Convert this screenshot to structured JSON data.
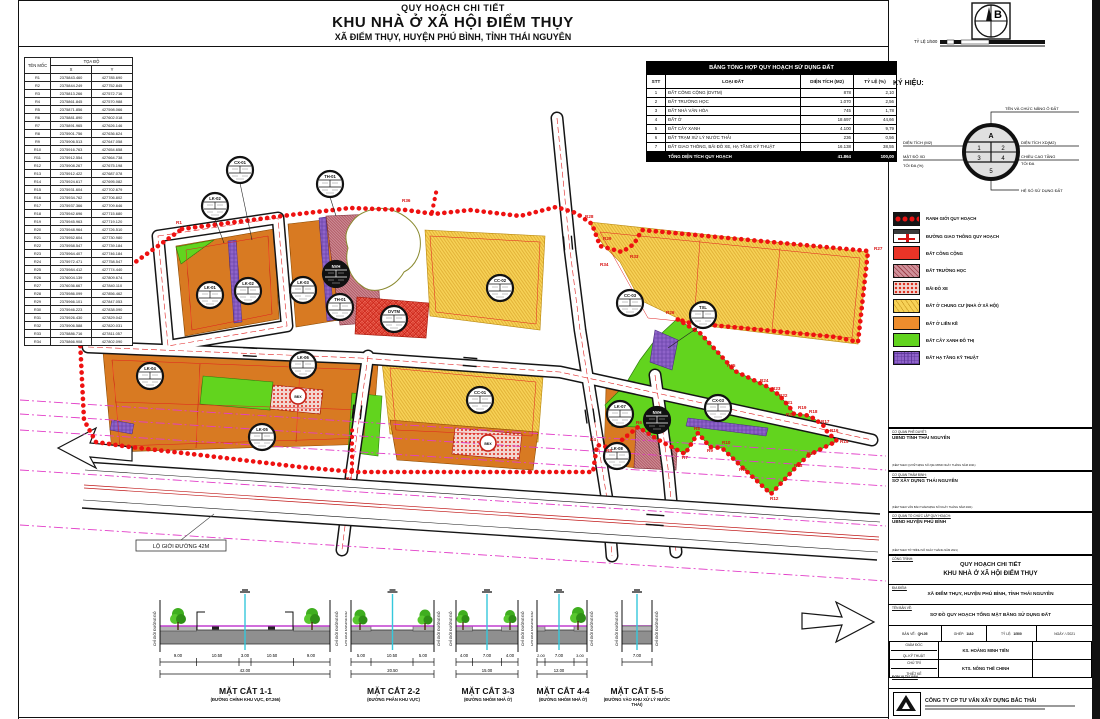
{
  "header": {
    "line1": "QUY HOẠCH CHI TIẾT",
    "line2": "KHU NHÀ Ở XÃ HỘI ĐIỂM THỤY",
    "line3": "XÃ ĐIỂM THỤY, HUYỆN PHÚ BÌNH, TỈNH THÁI NGUYÊN"
  },
  "north_label": "B",
  "scale_label": "TỶ LỆ 1/500",
  "coords": {
    "col_moc": "TÊN MỐC",
    "col_toado": "TỌA ĐỘ",
    "col_x": "X",
    "col_y": "Y",
    "rows": [
      {
        "id": "R1",
        "x": "2375843.460",
        "y": "427785.690"
      },
      {
        "id": "R2",
        "x": "2375844.249",
        "y": "427752.845"
      },
      {
        "id": "R3",
        "x": "2375813.266",
        "y": "427572.716"
      },
      {
        "id": "R4",
        "x": "2375861.845",
        "y": "427570.988"
      },
      {
        "id": "R5",
        "x": "2375871.856",
        "y": "427598.066"
      },
      {
        "id": "R6",
        "x": "2375881.890",
        "y": "427602.018"
      },
      {
        "id": "R7",
        "x": "2375891.965",
        "y": "427626.146"
      },
      {
        "id": "R8",
        "x": "2375901.756",
        "y": "427636.624"
      },
      {
        "id": "R9",
        "x": "2375906.513",
        "y": "427647.058"
      },
      {
        "id": "R10",
        "x": "2375916.763",
        "y": "427654.658"
      },
      {
        "id": "R11",
        "x": "2375912.554",
        "y": "427664.738"
      },
      {
        "id": "R12",
        "x": "2375908.267",
        "y": "427675.198"
      },
      {
        "id": "R13",
        "x": "2375912.422",
        "y": "427687.078"
      },
      {
        "id": "R14",
        "x": "2375924.617",
        "y": "427695.082"
      },
      {
        "id": "R15",
        "x": "2375931.604",
        "y": "427702.679"
      },
      {
        "id": "R16",
        "x": "2375934.762",
        "y": "427706.802"
      },
      {
        "id": "R17",
        "x": "2375937.366",
        "y": "427709.646"
      },
      {
        "id": "R18",
        "x": "2375942.696",
        "y": "427715.680"
      },
      {
        "id": "R19",
        "x": "2375945.963",
        "y": "427719.120"
      },
      {
        "id": "R20",
        "x": "2375948.964",
        "y": "427726.510"
      },
      {
        "id": "R21",
        "x": "2375952.604",
        "y": "427730.980"
      },
      {
        "id": "R22",
        "x": "2375958.547",
        "y": "427739.184"
      },
      {
        "id": "R23",
        "x": "2375964.407",
        "y": "427746.184"
      },
      {
        "id": "R24",
        "x": "2375972.471",
        "y": "427758.547"
      },
      {
        "id": "R25",
        "x": "2375984.412",
        "y": "427774.440"
      },
      {
        "id": "R26",
        "x": "2376004.139",
        "y": "427809.674"
      },
      {
        "id": "R27",
        "x": "2376036.667",
        "y": "427840.110"
      },
      {
        "id": "R28",
        "x": "2375986.099",
        "y": "427856.462"
      },
      {
        "id": "R29",
        "x": "2375966.101",
        "y": "427847.053"
      },
      {
        "id": "R30",
        "x": "2375946.223",
        "y": "427838.090"
      },
      {
        "id": "R31",
        "x": "2375926.430",
        "y": "427829.042"
      },
      {
        "id": "R32",
        "x": "2375906.588",
        "y": "427820.031"
      },
      {
        "id": "R33",
        "x": "2375886.716",
        "y": "427811.057"
      },
      {
        "id": "R34",
        "x": "2375866.908",
        "y": "427802.090"
      }
    ]
  },
  "landuse": {
    "title": "BẢNG TỔNG HỢP QUY HOẠCH SỬ DỤNG ĐẤT",
    "col_stt": "STT",
    "col_loai": "LOẠI ĐẤT",
    "col_dt": "DIỆN TÍCH (M2)",
    "col_tl": "TỶ LỆ (%)",
    "rows": [
      {
        "stt": "1",
        "name": "ĐẤT CÔNG CỘNG (DVTM)",
        "area": "878",
        "pct": "2,10"
      },
      {
        "stt": "2",
        "name": "ĐẤT TRƯỜNG HỌC",
        "area": "1.070",
        "pct": "2,56"
      },
      {
        "stt": "3",
        "name": "ĐẤT NHÀ VĂN HÓA",
        "area": "745",
        "pct": "1,78"
      },
      {
        "stt": "4",
        "name": "ĐẤT Ở",
        "area": "18.697",
        "pct": "44,66"
      },
      {
        "stt": "5",
        "name": "ĐẤT CÂY XANH",
        "area": "4.100",
        "pct": "9,79"
      },
      {
        "stt": "6",
        "name": "ĐẤT TRẠM XỬ LÝ NƯỚC THẢI",
        "area": "236",
        "pct": "0,56"
      },
      {
        "stt": "7",
        "name": "ĐẤT GIAO THÔNG, BÃI ĐỖ XE, HẠ TẦNG KỸ THUẬT",
        "area": "16.138",
        "pct": "38,55"
      }
    ],
    "total": {
      "label": "TỔNG DIỆN TÍCH QUY HOẠCH",
      "area": "41.864",
      "pct": "100,00"
    }
  },
  "legend": {
    "title": "KÝ HIỆU:",
    "symbol": {
      "top": "TÊN VÀ CHỨC NĂNG Ô ĐẤT",
      "left1": "DIỆN TÍCH (M2)",
      "left2": "MẬT ĐỘ XD",
      "left3": "TỐI ĐA (%)",
      "right1": "DIỆN TÍCH XD(M2)",
      "right2": "CHIỀU CAO TẦNG",
      "right3": "TỐI ĐA",
      "bottom": "HỆ SỐ SỬ DỤNG ĐẤT",
      "cA": "A",
      "c1": "1",
      "c2": "2",
      "c3": "3",
      "c4": "4",
      "c5": "5"
    },
    "items": [
      {
        "label": "RANH GIỚI QUY HOẠCH"
      },
      {
        "label": "ĐƯỜNG GIAO THÔNG QUY HOẠCH"
      },
      {
        "label": "ĐẤT CÔNG CỘNG"
      },
      {
        "label": "ĐẤT TRƯỜNG HỌC"
      },
      {
        "label": "BÃI ĐỖ XE"
      },
      {
        "label": "ĐẤT Ở CHUNG CƯ (NHÀ Ở XÃ HỘI)"
      },
      {
        "label": "ĐẤT Ở LIỀN KỀ"
      },
      {
        "label": "ĐẤT CÂY XANH ĐÔ THỊ"
      },
      {
        "label": "ĐẤT HẠ TẦNG KỸ THUẬT"
      }
    ]
  },
  "titleblock": {
    "approve_label": "CƠ QUAN PHÊ DUYỆT:",
    "approve": "UBND TỈNH THÁI NGUYÊN",
    "approve_note": "(KÈM THEO QUYẾT ĐỊNH SỐ       /QĐ-UBND NGÀY      THÁNG      NĂM 2021)",
    "verify_label": "CƠ QUAN THẨM ĐỊNH:",
    "verify": "SỞ XÂY DỰNG THÁI NGUYÊN",
    "verify_note": "(KÈM THEO VĂN BẢN THẨM ĐỊNH SỐ       NGÀY      THÁNG      NĂM 2021)",
    "org_label": "CƠ QUAN TỔ CHỨC LẬP QUY HOẠCH:",
    "org": "UBND HUYỆN PHÚ BÌNH",
    "org_note": "(KÈM THEO TỜ TRÌNH SỐ       NGÀY      THÁNG      NĂM 2021)",
    "project_label": "CÔNG TRÌNH:",
    "project1": "QUY HOẠCH CHI TIẾT",
    "project2": "KHU NHÀ Ở XÃ HỘI ĐIỂM THỤY",
    "location_label": "ĐỊA ĐIỂM:",
    "location": "XÃ ĐIỂM THỤY, HUYỆN PHÚ BÌNH, TỈNH THÁI NGUYÊN",
    "drawing_label": "TÊN BẢN VẼ:",
    "drawing": "SƠ ĐỒ QUY HOẠCH TỔNG MẶT BẰNG SỬ DỤNG ĐẤT",
    "banve_l": "BẢN VẼ:",
    "banve": "QH-05",
    "ghep_l": "GHÉP:",
    "ghep": "1/A0",
    "tyle_l": "TỶ LỆ:",
    "tyle": "1/500",
    "ngay": "NGÀY    /    /2021",
    "giamdoc_l": "GIÁM ĐỐC",
    "qlkt_l": "QL.KỸ THUẬT",
    "giamdoc": "KS. HOÀNG MINH TIẾN",
    "chutri_l": "CHỦ TRÌ",
    "thietke_l": "THIẾT KẾ",
    "chutri": "KTS. NÔNG THẾ CHINH",
    "donvi": "ĐƠN VỊ TƯ VẤN",
    "company": "CÔNG TY CP TƯ VẤN  XÂY DỰNG BẮC THÁI"
  },
  "map": {
    "road42_label": "LỘ GIỚI ĐƯỜNG 42M",
    "lots": [
      {
        "label": "CX-01",
        "x": 240,
        "y": 170
      },
      {
        "label": "TH-01",
        "x": 330,
        "y": 184
      },
      {
        "label": "LK-02",
        "x": 215,
        "y": 206
      },
      {
        "label": "LK-01",
        "x": 210,
        "y": 295
      },
      {
        "label": "LK-02",
        "x": 248,
        "y": 291
      },
      {
        "label": "LK-03",
        "x": 303,
        "y": 290
      },
      {
        "label": "NVH",
        "x": 336,
        "y": 274,
        "dark": true
      },
      {
        "label": "TH-01",
        "x": 340,
        "y": 307
      },
      {
        "label": "DVTM",
        "x": 394,
        "y": 319
      },
      {
        "label": "CC-02",
        "x": 500,
        "y": 288
      },
      {
        "label": "CC-03",
        "x": 630,
        "y": 303
      },
      {
        "label": "TXL",
        "x": 703,
        "y": 315
      },
      {
        "label": "CC-01",
        "x": 480,
        "y": 400
      },
      {
        "label": "LK-04",
        "x": 150,
        "y": 376
      },
      {
        "label": "LK-06",
        "x": 303,
        "y": 365
      },
      {
        "label": "LK-05",
        "x": 262,
        "y": 437
      },
      {
        "label": "BĐX",
        "x": 298,
        "y": 396,
        "small": true,
        "red": true
      },
      {
        "label": "BĐX",
        "x": 488,
        "y": 443,
        "small": true,
        "red": true
      },
      {
        "label": "LK-07",
        "x": 620,
        "y": 414
      },
      {
        "label": "NVH",
        "x": 657,
        "y": 420,
        "dark": true
      },
      {
        "label": "LK-08",
        "x": 617,
        "y": 456
      },
      {
        "label": "CX-03",
        "x": 718,
        "y": 408
      }
    ],
    "rpoints": [
      {
        "id": "R1",
        "x": 176,
        "y": 224
      },
      {
        "id": "R2",
        "x": 74,
        "y": 300
      },
      {
        "id": "R3",
        "x": 346,
        "y": 480
      },
      {
        "id": "R4",
        "x": 590,
        "y": 441
      },
      {
        "id": "R5",
        "x": 606,
        "y": 452
      },
      {
        "id": "R6",
        "x": 636,
        "y": 424
      },
      {
        "id": "R7",
        "x": 682,
        "y": 459
      },
      {
        "id": "R8",
        "x": 694,
        "y": 430
      },
      {
        "id": "R9",
        "x": 707,
        "y": 452
      },
      {
        "id": "R10",
        "x": 722,
        "y": 444
      },
      {
        "id": "R11",
        "x": 739,
        "y": 471
      },
      {
        "id": "R12",
        "x": 770,
        "y": 500
      },
      {
        "id": "R13",
        "x": 794,
        "y": 467
      },
      {
        "id": "R14",
        "x": 807,
        "y": 455
      },
      {
        "id": "R15",
        "x": 840,
        "y": 443
      },
      {
        "id": "R16",
        "x": 830,
        "y": 432
      },
      {
        "id": "R17",
        "x": 821,
        "y": 423
      },
      {
        "id": "R18",
        "x": 809,
        "y": 413
      },
      {
        "id": "R19",
        "x": 798,
        "y": 409
      },
      {
        "id": "R20",
        "x": 786,
        "y": 416
      },
      {
        "id": "R21",
        "x": 784,
        "y": 404
      },
      {
        "id": "R22",
        "x": 779,
        "y": 397
      },
      {
        "id": "R23",
        "x": 772,
        "y": 390
      },
      {
        "id": "R24",
        "x": 760,
        "y": 382
      },
      {
        "id": "R25",
        "x": 727,
        "y": 367
      },
      {
        "id": "R26",
        "x": 666,
        "y": 314
      },
      {
        "id": "R27",
        "x": 874,
        "y": 250
      },
      {
        "id": "R28",
        "x": 585,
        "y": 218
      },
      {
        "id": "R29",
        "x": 603,
        "y": 240
      },
      {
        "id": "R33",
        "x": 630,
        "y": 258
      },
      {
        "id": "R34",
        "x": 600,
        "y": 266
      },
      {
        "id": "R36",
        "x": 402,
        "y": 202
      }
    ]
  },
  "sections_side_label": "CHỈ GIỚI ĐƯỜNG ĐỎ",
  "sections": [
    {
      "name": "MẶT CẮT 1-1",
      "sub": "(ĐƯỜNG CHÍNH KHU VỰC, ĐT.266)",
      "dims": [
        "9.00",
        "10.50",
        "3.00",
        "10.50",
        "9.00"
      ],
      "total": "42.00"
    },
    {
      "name": "MẶT CẮT 2-2",
      "sub": "(ĐƯỜNG PHÂN KHU VỰC)",
      "dims": [
        "5.00",
        "10.50",
        "5.00"
      ],
      "total": "20.50"
    },
    {
      "name": "MẶT CẮT 3-3",
      "sub": "(ĐƯỜNG NHÓM NHÀ Ở)",
      "dims": [
        "4.00",
        "7.00",
        "4.00"
      ],
      "total": "15.00"
    },
    {
      "name": "MẶT CẮT 4-4",
      "sub": "(ĐƯỜNG NHÓM NHÀ Ở)",
      "dims": [
        "2.00",
        "7.00",
        "3.00"
      ],
      "total": "12.00"
    },
    {
      "name": "MẶT CẮT 5-5",
      "sub": "(ĐƯỜNG VÀO KHU XỬ LÝ NƯỚC THẢI)",
      "dims": [
        "7.00"
      ],
      "total": "7.00"
    }
  ]
}
